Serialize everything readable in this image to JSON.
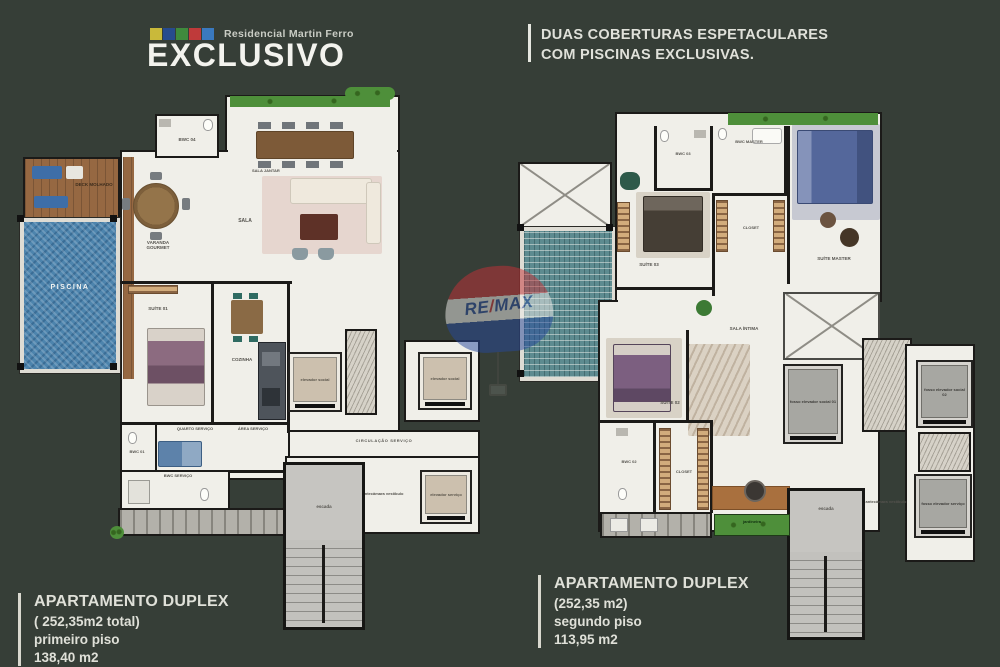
{
  "brand": {
    "project": "Residencial Martin Ferro",
    "title": "EXCLUSIVO"
  },
  "tagline": {
    "line1": "DUAS COBERTURAS ESPETACULARES",
    "line2": "COM PISCINAS EXCLUSIVAS."
  },
  "watermark": {
    "re": "RE",
    "slash": "/",
    "max": "MAX"
  },
  "plan_first": {
    "caption": {
      "title": "APARTAMENTO DUPLEX",
      "area_total": "( 252,35m2 total)",
      "floor": "primeiro piso",
      "area": "138,40 m2"
    },
    "labels": {
      "piscina": "PISCINA",
      "deck": "DECK MOLHADO",
      "varanda_gourmet": "VARANDA GOURMET",
      "sala_jantar": "SALA JANTAR",
      "sala": "SALA",
      "bwc04": "BWC 04",
      "suite01": "SUÍTE 01",
      "cozinha": "COZINHA",
      "quarto_servico": "QUARTO SERVIÇO",
      "area_servico": "ÁREA SERVIÇO",
      "bwc01": "BWC 01",
      "bwc_servico": "BWC SERVIÇO",
      "elevador_social_1": "elevador social",
      "elevador_social_2": "elevador social",
      "circulacao_servico": "CIRCULAÇÃO SERVIÇO",
      "antecamara": "antecâmara vestíbulo",
      "elevador_servico": "elevador serviço",
      "escada": "escada"
    }
  },
  "plan_second": {
    "caption": {
      "title": "APARTAMENTO DUPLEX",
      "area_total": "(252,35 m2)",
      "floor": "segundo piso",
      "area": "113,95 m2"
    },
    "labels": {
      "bwc03": "BWC 03",
      "bwc_master": "BWC MASTER",
      "closet_master": "CLOSET",
      "suite_master": "SUÍTE MASTER",
      "suite03": "SUÍTE 03",
      "sala_intima": "SALA ÍNTIMA",
      "suite02": "SUÍTE 02",
      "bwc02": "BWC 02",
      "closet02": "CLOSET",
      "fosso_social_01": "fosso elevador social 01",
      "fosso_social_02": "fosso elevador social 02",
      "fosso_servico": "fosso elevador serviço",
      "escada": "escada",
      "antecamara": "antecâmara vestíbulo",
      "jardineira": "jardineira"
    }
  },
  "colors": {
    "background": "#363e37",
    "floor": "#f0efe9",
    "pool": "#4d84ad",
    "accent_red": "#c53237",
    "accent_blue": "#27489c",
    "text_light": "#dfe0d8"
  }
}
